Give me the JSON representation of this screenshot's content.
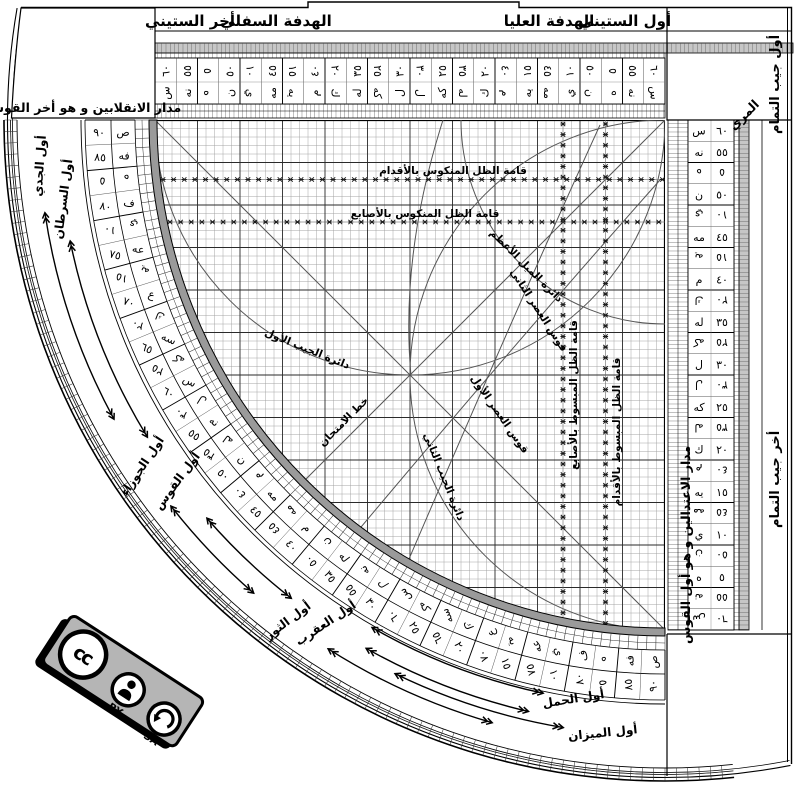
{
  "top": {
    "last_sixty": "أخر الستيني",
    "lower_sight": "الهدفة السفلي",
    "upper_sight": "الهدفة العليا",
    "first_sixty": "أول الستيني",
    "muri": "المري"
  },
  "corners": {
    "top_left_box": "مدار الانقلابين و هو أخر القوس",
    "bottom_right_box": "مدار الاعتدالين و هو أول القوس",
    "cosine_start": "أول جيب التمام",
    "cosine_end": "أخر جيب التمام"
  },
  "grid_labels": {
    "reversed_shadow_feet": "قامة الظل المنكوس بالأقدام",
    "reversed_shadow_digits": "قامة الظل المنكوس بالأصابع",
    "flat_shadow_digits": "قامة الظل المبسوط بالأصابع",
    "flat_shadow_feet": "قامة الظل المبسوط بالأقدام",
    "declination_circle": "دائرة الميل الأعظم",
    "first_sine_circle": "دائرة الجيب الأول",
    "second_sine_circle": "دائرة الجيب الثاني",
    "first_asr_arc": "قوس العصر الأول",
    "second_asr_arc": "قوس العصر الثاني",
    "test_line": "خط الامتحان"
  },
  "zodiac": {
    "labels": [
      "أول الجدي",
      "أول السرطان",
      "أول الجوزاء",
      "أول القوس",
      "أول الثور",
      "أول العقرب",
      "أول الحمل",
      "أول الميزان"
    ]
  },
  "scales": {
    "arc": [
      {
        "n": "٩٠",
        "l": "ص",
        "f": false
      },
      {
        "n": "٨٥",
        "l": "فه",
        "f": false
      },
      {
        "n": "٥",
        "l": "ه",
        "f": true
      },
      {
        "n": "٨٠",
        "l": "ف",
        "f": false
      },
      {
        "n": "١٠",
        "l": "ي",
        "f": true
      },
      {
        "n": "٧٥",
        "l": "عه",
        "f": false
      },
      {
        "n": "١٥",
        "l": "يه",
        "f": true
      },
      {
        "n": "٧٠",
        "l": "ع",
        "f": false
      },
      {
        "n": "٢٠",
        "l": "ك",
        "f": true
      },
      {
        "n": "٦٥",
        "l": "سه",
        "f": false
      },
      {
        "n": "٢٥",
        "l": "كه",
        "f": true
      },
      {
        "n": "٦٠",
        "l": "س",
        "f": false
      },
      {
        "n": "٣٠",
        "l": "ل",
        "f": true
      },
      {
        "n": "٥٥",
        "l": "نه",
        "f": false
      },
      {
        "n": "٣٥",
        "l": "له",
        "f": true
      },
      {
        "n": "٥٠",
        "l": "ن",
        "f": false
      },
      {
        "n": "٤٠",
        "l": "م",
        "f": true
      },
      {
        "n": "٤٥",
        "l": "مه",
        "f": false
      },
      {
        "n": "٤٥",
        "l": "مه",
        "f": true
      },
      {
        "n": "٤٠",
        "l": "م",
        "f": false
      },
      {
        "n": "٥٠",
        "l": "ن",
        "f": true
      },
      {
        "n": "٣٥",
        "l": "له",
        "f": false
      },
      {
        "n": "٥٥",
        "l": "نه",
        "f": true
      },
      {
        "n": "٣٠",
        "l": "ل",
        "f": false
      },
      {
        "n": "٦٠",
        "l": "س",
        "f": true
      },
      {
        "n": "٢٥",
        "l": "كه",
        "f": false
      },
      {
        "n": "٦٥",
        "l": "سه",
        "f": true
      },
      {
        "n": "٢٠",
        "l": "ك",
        "f": false
      },
      {
        "n": "٧٠",
        "l": "ع",
        "f": true
      },
      {
        "n": "١٥",
        "l": "يه",
        "f": false
      },
      {
        "n": "٧٥",
        "l": "عه",
        "f": true
      },
      {
        "n": "١٠",
        "l": "ي",
        "f": false
      },
      {
        "n": "٨٠",
        "l": "ف",
        "f": true
      },
      {
        "n": "٥",
        "l": "ه",
        "f": false
      },
      {
        "n": "٨٥",
        "l": "فه",
        "f": true
      },
      {
        "n": "٩٠",
        "l": "ص",
        "f": true
      }
    ],
    "top": [
      {
        "n": "٦٠",
        "l": "س",
        "f": false
      },
      {
        "n": "٥٥",
        "l": "نه",
        "f": false
      },
      {
        "n": "٥",
        "l": "ه",
        "f": true
      },
      {
        "n": "٥٠",
        "l": "ن",
        "f": false
      },
      {
        "n": "١٠",
        "l": "ي",
        "f": true
      },
      {
        "n": "٤٥",
        "l": "مه",
        "f": false
      },
      {
        "n": "١٥",
        "l": "يه",
        "f": true
      },
      {
        "n": "٤٠",
        "l": "م",
        "f": false
      },
      {
        "n": "٢٠",
        "l": "ك",
        "f": true
      },
      {
        "n": "٣٥",
        "l": "له",
        "f": false
      },
      {
        "n": "٢٥",
        "l": "كه",
        "f": true
      },
      {
        "n": "٣٠",
        "l": "ل",
        "f": false
      },
      {
        "n": "٣٠",
        "l": "ل",
        "f": true
      },
      {
        "n": "٢٥",
        "l": "كه",
        "f": false
      },
      {
        "n": "٣٥",
        "l": "له",
        "f": true
      },
      {
        "n": "٢٠",
        "l": "ك",
        "f": false
      },
      {
        "n": "٤٠",
        "l": "م",
        "f": true
      },
      {
        "n": "١٥",
        "l": "يه",
        "f": false
      },
      {
        "n": "٤٥",
        "l": "مه",
        "f": true
      },
      {
        "n": "١٠",
        "l": "ي",
        "f": false
      },
      {
        "n": "٥٠",
        "l": "ن",
        "f": true
      },
      {
        "n": "٥",
        "l": "ه",
        "f": false
      },
      {
        "n": "٥٥",
        "l": "نه",
        "f": true
      },
      {
        "n": "٦٠",
        "l": "س",
        "f": true
      }
    ],
    "right": [
      {
        "n": "٦٠",
        "l": "س",
        "f": false
      },
      {
        "n": "٥٥",
        "l": "نه",
        "f": false
      },
      {
        "n": "٥",
        "l": "ه",
        "f": true
      },
      {
        "n": "٥٠",
        "l": "ن",
        "f": false
      },
      {
        "n": "١٠",
        "l": "ي",
        "f": true
      },
      {
        "n": "٤٥",
        "l": "مه",
        "f": false
      },
      {
        "n": "١٥",
        "l": "يه",
        "f": true
      },
      {
        "n": "٤٠",
        "l": "م",
        "f": false
      },
      {
        "n": "٢٠",
        "l": "ك",
        "f": true
      },
      {
        "n": "٣٥",
        "l": "له",
        "f": false
      },
      {
        "n": "٢٥",
        "l": "كه",
        "f": true
      },
      {
        "n": "٣٠",
        "l": "ل",
        "f": false
      },
      {
        "n": "٣٠",
        "l": "ل",
        "f": true
      },
      {
        "n": "٢٥",
        "l": "كه",
        "f": false
      },
      {
        "n": "٣٥",
        "l": "له",
        "f": true
      },
      {
        "n": "٢٠",
        "l": "ك",
        "f": false
      },
      {
        "n": "٤٠",
        "l": "م",
        "f": true
      },
      {
        "n": "١٥",
        "l": "يه",
        "f": false
      },
      {
        "n": "٤٥",
        "l": "مه",
        "f": true
      },
      {
        "n": "١٠",
        "l": "ي",
        "f": false
      },
      {
        "n": "٥٠",
        "l": "ن",
        "f": true
      },
      {
        "n": "٥",
        "l": "ه",
        "f": false
      },
      {
        "n": "٥٥",
        "l": "نه",
        "f": true
      },
      {
        "n": "٦٠",
        "l": "س",
        "f": true
      }
    ]
  },
  "badge": {
    "cc": "cc",
    "by": "BY",
    "sa": "SA"
  },
  "colors": {
    "band_gray": "#c6c6c6",
    "edge_gray": "#9a9a9a",
    "ink": "#000000",
    "grid_minor": "#9c9c9c",
    "grid_major": "#2a2a2a",
    "badge_gray": "#b5b5b5"
  }
}
